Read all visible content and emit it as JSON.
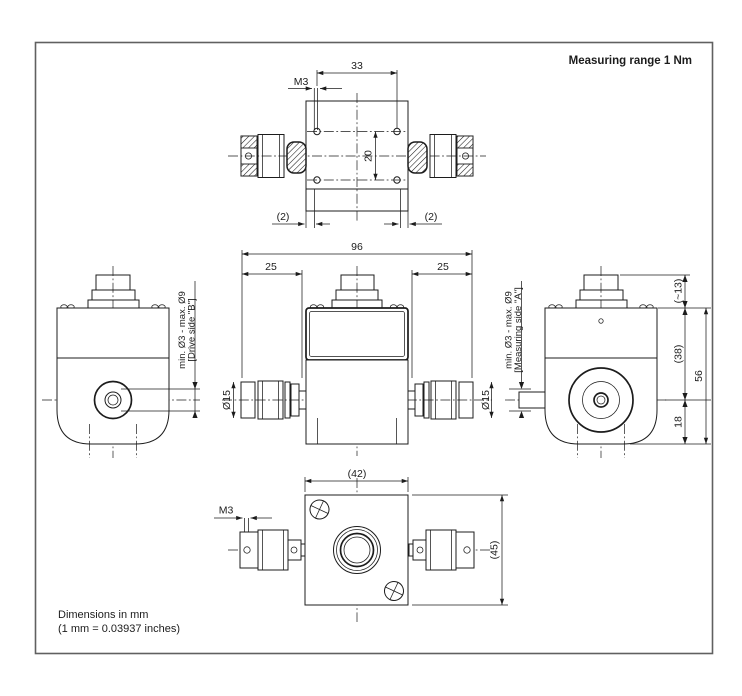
{
  "title": "Measuring range 1 Nm",
  "notes": {
    "line1": "Dimensions in mm",
    "line2": "(1 mm = 0.03937 inches)"
  },
  "top_view": {
    "dim_hole_spacing_h": "33",
    "thread_label": "M3",
    "dim_hole_spacing_v": "20",
    "dim_offset_left": "(2)",
    "dim_offset_right": "(2)"
  },
  "front_view": {
    "dim_total_length": "96",
    "dim_shaft_left": "25",
    "dim_shaft_right": "25",
    "dim_coupling_dia_left": "Ø15",
    "dim_coupling_dia_right": "Ø15"
  },
  "left_view": {
    "shaft_range_label": "min. Ø3 - max. Ø9",
    "side_label": "[Drive side \"B\"]"
  },
  "right_view": {
    "shaft_range_label": "min. Ø3 - max. Ø9",
    "side_label": "[Measuring side \"A\"]",
    "dim_connector_height": "(~13)",
    "dim_body_top": "(38)",
    "dim_body_total": "56",
    "dim_body_bottom": "18"
  },
  "bottom_view": {
    "dim_width": "(42)",
    "thread_label": "M3",
    "dim_height": "(45)"
  },
  "colors": {
    "line": "#1c1c1c",
    "frame": "#606060",
    "background": "#ffffff"
  }
}
